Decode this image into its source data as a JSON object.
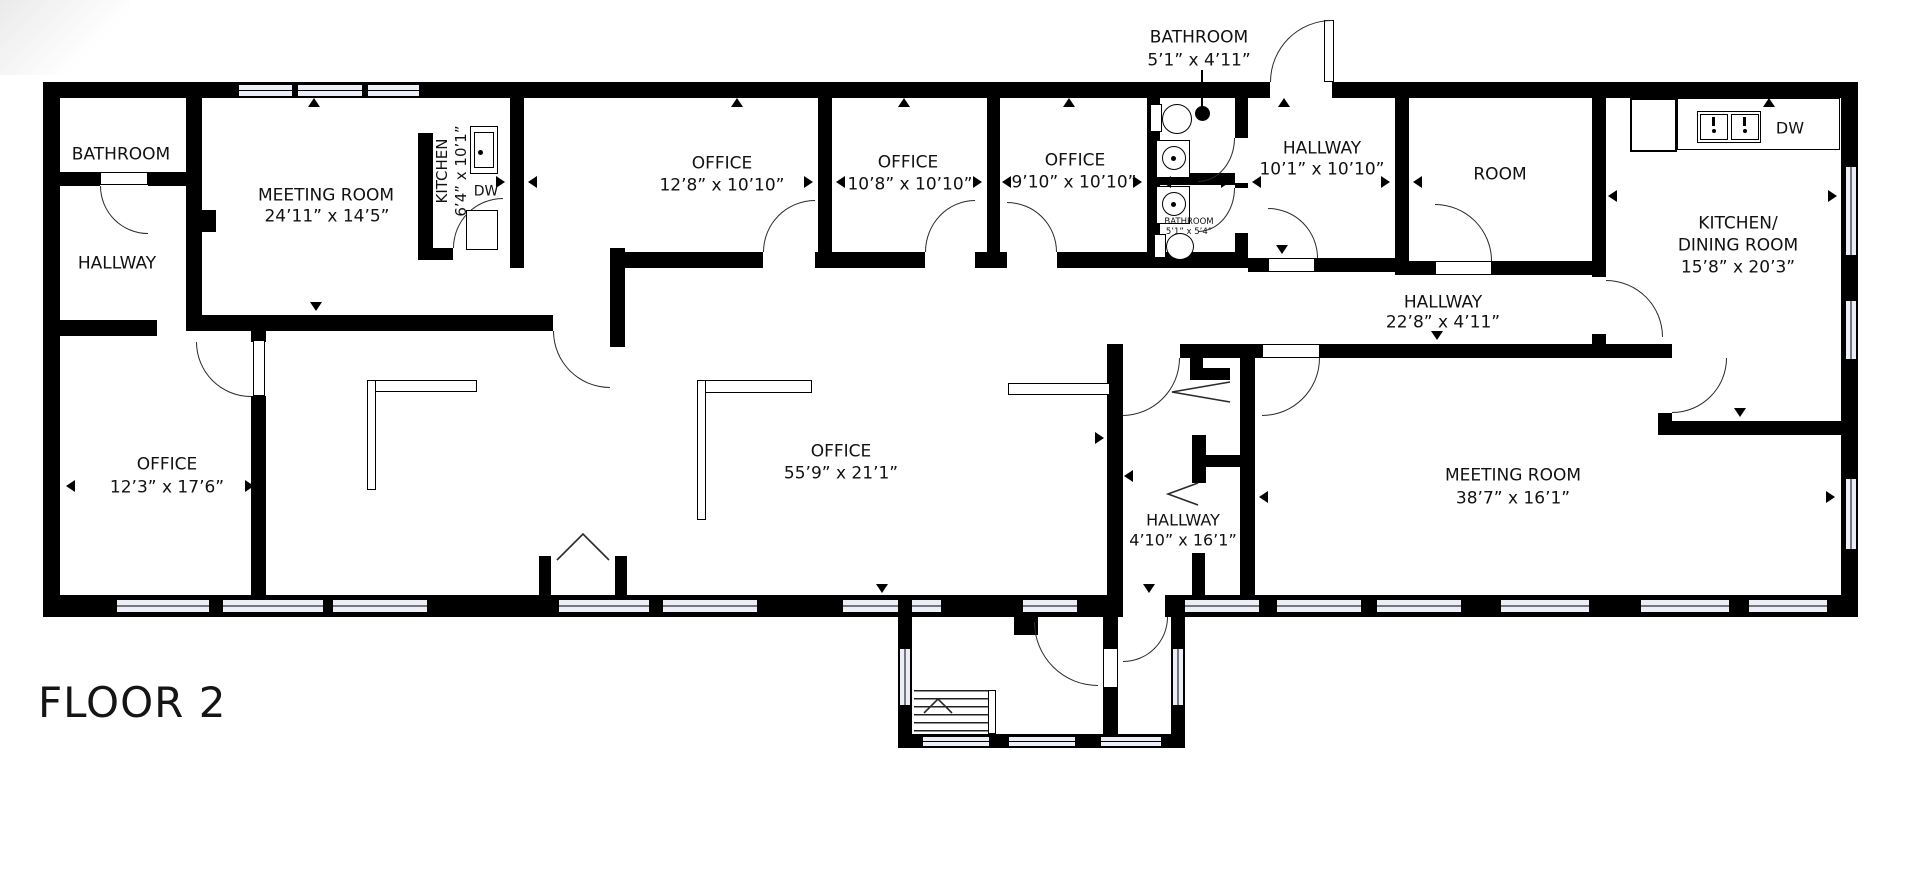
{
  "floor_title": "FLOOR 2",
  "labels": {
    "bathroom_tl": {
      "name": "BATHROOM"
    },
    "hallway_left": {
      "name": "HALLWAY"
    },
    "meeting_room_1": {
      "name": "MEETING ROOM",
      "dims": "24’11” x 14’5”"
    },
    "kitchen": {
      "name": "KITCHEN",
      "dims": "6’4” x 10’1”",
      "dw": "DW"
    },
    "office_1": {
      "name": "OFFICE",
      "dims": "12’8” x 10’10”"
    },
    "office_2": {
      "name": "OFFICE",
      "dims": "10’8” x 10’10”"
    },
    "office_3": {
      "name": "OFFICE",
      "dims": "9’10” x 10’10”"
    },
    "bathroom_callout": {
      "name": "BATHROOM",
      "dims": "5’1” x 4’11”"
    },
    "bathroom_small": {
      "name": "BATHROOM",
      "dims": "5’1” x 5’4”"
    },
    "hallway_center": {
      "name": "HALLWAY",
      "dims": "10’1” x 10’10”"
    },
    "room": {
      "name": "ROOM"
    },
    "kitchen_dining": {
      "line1": "K ITCHEN/",
      "line2": "DINING ROOM",
      "dims": "15’8” x 20’3”",
      "dw": "DW"
    },
    "hallway_long": {
      "name": "HALLWAY",
      "dims": "22’8” x 4’11”"
    },
    "office_4": {
      "name": "OFFICE",
      "dims": "12’3” x 17’6”"
    },
    "office_open": {
      "name": "OFFICE",
      "dims": "55’9” x 21’1”"
    },
    "hallway_vert": {
      "name": "HALLWAY",
      "dims": "4’10” x 16’1”"
    },
    "meeting_room_2": {
      "name": "MEETING ROOM",
      "dims": "38’7” x 16’1”"
    }
  },
  "colors": {
    "wall": "#000000",
    "window_fill": "#eceef7",
    "text": "#111111"
  }
}
